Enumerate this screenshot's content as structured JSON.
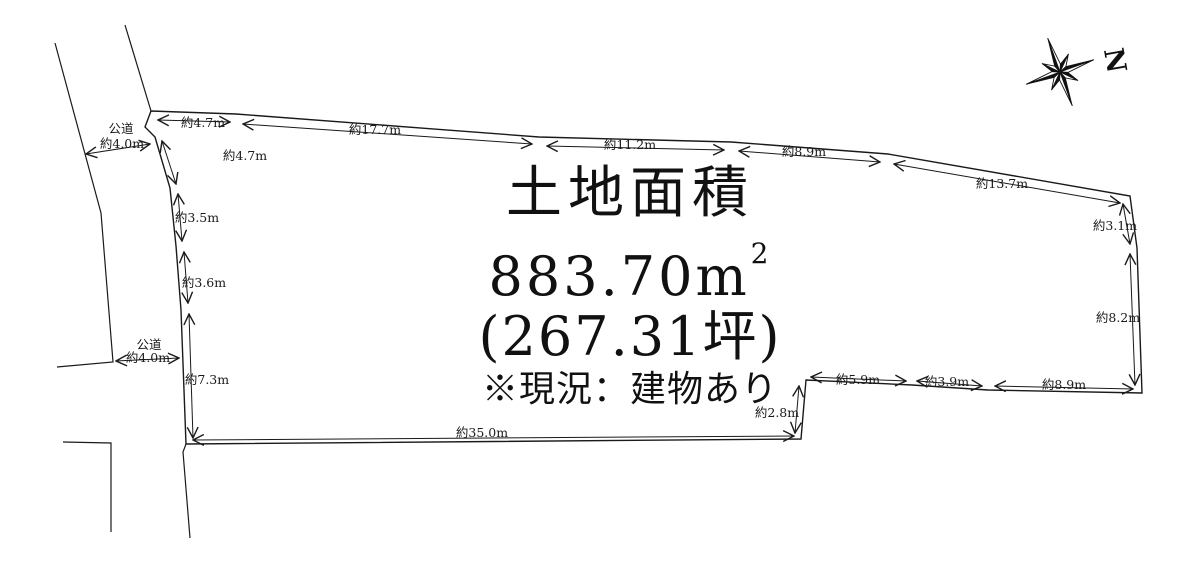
{
  "page": {
    "background": "#ffffff",
    "ink": "#1a1a1a"
  },
  "area_info": {
    "title": "土地面積",
    "area_value": "883.70",
    "area_unit": "m",
    "area_exponent": "2",
    "tsubo": "(267.31坪)",
    "note": "※現況：建物あり"
  },
  "compass": {
    "label": "N"
  },
  "diagram": {
    "dimension_labels": [
      {
        "text": "約4.7m",
        "x": 203,
        "y": 127
      },
      {
        "text": "約17.7m",
        "x": 375,
        "y": 134
      },
      {
        "text": "約11.2m",
        "x": 630,
        "y": 149
      },
      {
        "text": "約8.9m",
        "x": 804,
        "y": 156
      },
      {
        "text": "約13.7m",
        "x": 1002,
        "y": 188
      },
      {
        "text": "約3.1m",
        "x": 1115,
        "y": 230
      },
      {
        "text": "約8.2m",
        "x": 1118,
        "y": 322
      },
      {
        "text": "約8.9m",
        "x": 1064,
        "y": 389
      },
      {
        "text": "約3.9m",
        "x": 947,
        "y": 386
      },
      {
        "text": "約5.9m",
        "x": 858,
        "y": 384
      },
      {
        "text": "約2.8m",
        "x": 777,
        "y": 417
      },
      {
        "text": "約35.0m",
        "x": 482,
        "y": 437
      },
      {
        "text": "約7.3m",
        "x": 207,
        "y": 384
      },
      {
        "text": "約3.6m",
        "x": 204,
        "y": 287
      },
      {
        "text": "約3.5m",
        "x": 197,
        "y": 222
      },
      {
        "text": "約4.7m",
        "x": 245,
        "y": 160
      }
    ],
    "road_labels": [
      {
        "text": "公道",
        "x": 121,
        "y": 133
      },
      {
        "text": "約4.0m",
        "x": 122,
        "y": 148
      },
      {
        "text": "公道",
        "x": 149,
        "y": 349
      },
      {
        "text": "約4.0m",
        "x": 148,
        "y": 362
      }
    ]
  }
}
